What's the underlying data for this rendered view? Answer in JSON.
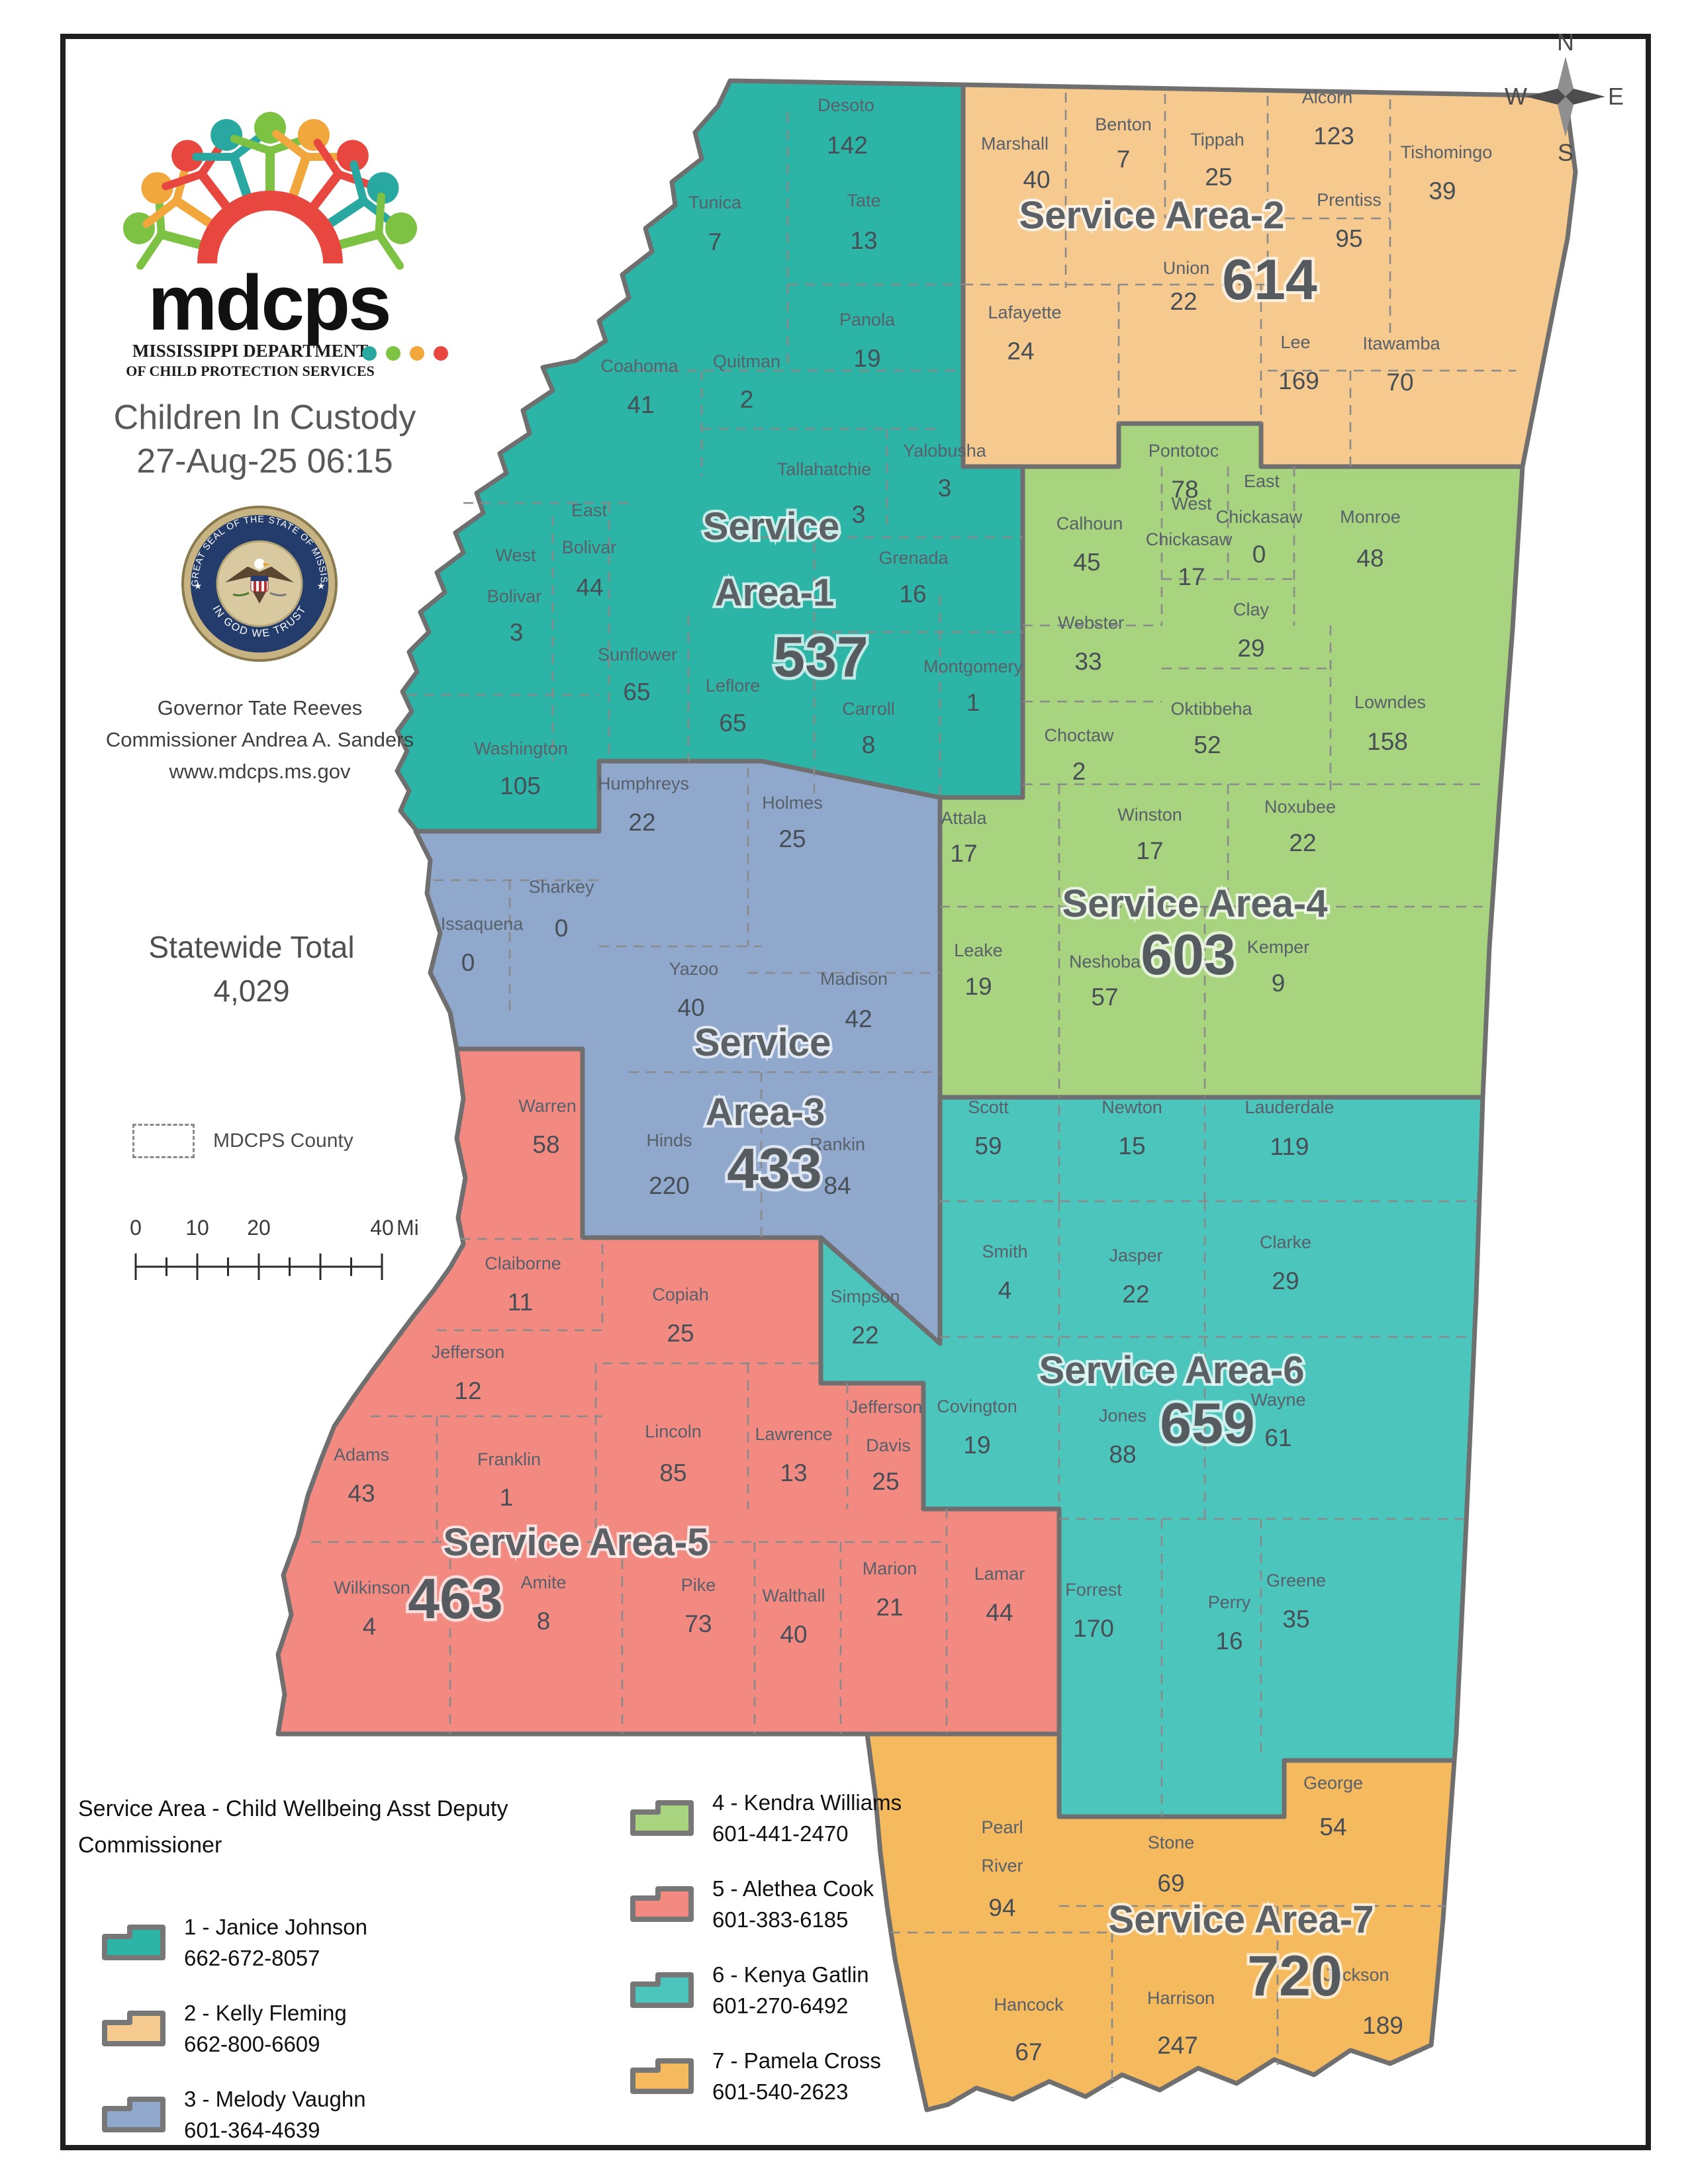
{
  "header": {
    "logo_text": "mdcps",
    "logo_sub1": "MISSISSIPPI DEPARTMENT",
    "logo_sub2": "OF CHILD PROTECTION SERVICES",
    "title": "Children In Custody",
    "datetime": "27-Aug-25 06:15",
    "seal_top": "THE GREAT SEAL OF THE STATE OF MISSISSIPPI",
    "seal_bottom": "IN GOD WE TRUST",
    "governor": "Governor Tate Reeves",
    "commissioner": "Commissioner Andrea A. Sanders",
    "website": "www.mdcps.ms.gov",
    "statewide_label": "Statewide Total",
    "statewide_total": "4,029",
    "county_legend_label": "MDCPS County",
    "scale": {
      "t0": "0",
      "t10": "10",
      "t20": "20",
      "t40": "40",
      "unit": "Miles"
    },
    "compass": {
      "n": "N",
      "e": "E",
      "s": "S",
      "w": "W"
    }
  },
  "legend": {
    "title_line1": "Service Area - Child Wellbeing Asst Deputy",
    "title_line2": "Commissioner",
    "items": [
      {
        "label": "1 - Janice Johnson",
        "phone": "662-672-8057",
        "color": "#2cb5a7"
      },
      {
        "label": "2 - Kelly Fleming",
        "phone": "662-800-6609",
        "color": "#f6c98f"
      },
      {
        "label": "3 - Melody Vaughn",
        "phone": "601-364-4639",
        "color": "#8fa8cc"
      },
      {
        "label": "4 - Kendra Williams",
        "phone": "601-441-2470",
        "color": "#a8d47f"
      },
      {
        "label": "5 - Alethea Cook",
        "phone": "601-383-6185",
        "color": "#f38a82"
      },
      {
        "label": "6 - Kenya Gatlin",
        "phone": "601-270-6492",
        "color": "#4cc5bd"
      },
      {
        "label": "7 - Pamela Cross",
        "phone": "601-540-2623",
        "color": "#f5b95e"
      }
    ]
  },
  "map": {
    "service_areas": [
      {
        "id": 1,
        "label": "Service Area-1",
        "total": "537",
        "color": "#2cb5a7",
        "counties": [
          {
            "name": "Desoto",
            "value": "142"
          },
          {
            "name": "Tunica",
            "value": "7"
          },
          {
            "name": "Tate",
            "value": "13"
          },
          {
            "name": "Panola",
            "value": "19"
          },
          {
            "name": "Coahoma",
            "value": "41"
          },
          {
            "name": "Quitman",
            "value": "2"
          },
          {
            "name": "Tallahatchie",
            "value": "3"
          },
          {
            "name": "Yalobusha",
            "value": "3"
          },
          {
            "name": "East Bolivar",
            "value": "44"
          },
          {
            "name": "West Bolivar",
            "value": "3"
          },
          {
            "name": "Grenada",
            "value": "16"
          },
          {
            "name": "Sunflower",
            "value": "65"
          },
          {
            "name": "Leflore",
            "value": "65"
          },
          {
            "name": "Carroll",
            "value": "8"
          },
          {
            "name": "Montgomery",
            "value": "1"
          },
          {
            "name": "Washington",
            "value": "105"
          }
        ]
      },
      {
        "id": 2,
        "label": "Service Area-2",
        "total": "614",
        "color": "#f6c98f",
        "counties": [
          {
            "name": "Marshall",
            "value": "40"
          },
          {
            "name": "Benton",
            "value": "7"
          },
          {
            "name": "Tippah",
            "value": "25"
          },
          {
            "name": "Alcorn",
            "value": "123"
          },
          {
            "name": "Tishomingo",
            "value": "39"
          },
          {
            "name": "Prentiss",
            "value": "95"
          },
          {
            "name": "Union",
            "value": "22"
          },
          {
            "name": "Lafayette",
            "value": "24"
          },
          {
            "name": "Lee",
            "value": "169"
          },
          {
            "name": "Itawamba",
            "value": "70"
          }
        ]
      },
      {
        "id": 3,
        "label": "Service Area-3",
        "total": "433",
        "color": "#8fa8cc",
        "counties": [
          {
            "name": "Humphreys",
            "value": "22"
          },
          {
            "name": "Holmes",
            "value": "25"
          },
          {
            "name": "Sharkey",
            "value": "0"
          },
          {
            "name": "Issaquena",
            "value": "0"
          },
          {
            "name": "Yazoo",
            "value": "40"
          },
          {
            "name": "Madison",
            "value": "42"
          },
          {
            "name": "Hinds",
            "value": "220"
          },
          {
            "name": "Rankin",
            "value": "84"
          }
        ]
      },
      {
        "id": 4,
        "label": "Service Area-4",
        "total": "603",
        "color": "#a8d47f",
        "counties": [
          {
            "name": "Pontotoc",
            "value": "78"
          },
          {
            "name": "Calhoun",
            "value": "45"
          },
          {
            "name": "West Chickasaw",
            "value": "17"
          },
          {
            "name": "East Chickasaw",
            "value": "0"
          },
          {
            "name": "Monroe",
            "value": "48"
          },
          {
            "name": "Webster",
            "value": "33"
          },
          {
            "name": "Clay",
            "value": "29"
          },
          {
            "name": "Oktibbeha",
            "value": "52"
          },
          {
            "name": "Lowndes",
            "value": "158"
          },
          {
            "name": "Choctaw",
            "value": "2"
          },
          {
            "name": "Attala",
            "value": "17"
          },
          {
            "name": "Winston",
            "value": "17"
          },
          {
            "name": "Noxubee",
            "value": "22"
          },
          {
            "name": "Leake",
            "value": "19"
          },
          {
            "name": "Neshoba",
            "value": "57"
          },
          {
            "name": "Kemper",
            "value": "9"
          }
        ]
      },
      {
        "id": 5,
        "label": "Service Area-5",
        "total": "463",
        "color": "#f38a82",
        "counties": [
          {
            "name": "Warren",
            "value": "58"
          },
          {
            "name": "Claiborne",
            "value": "11"
          },
          {
            "name": "Copiah",
            "value": "25"
          },
          {
            "name": "Jefferson",
            "value": "12"
          },
          {
            "name": "Adams",
            "value": "43"
          },
          {
            "name": "Franklin",
            "value": "1"
          },
          {
            "name": "Lincoln",
            "value": "85"
          },
          {
            "name": "Lawrence",
            "value": "13"
          },
          {
            "name": "Jefferson Davis",
            "value": "25"
          },
          {
            "name": "Wilkinson",
            "value": "4"
          },
          {
            "name": "Amite",
            "value": "8"
          },
          {
            "name": "Pike",
            "value": "73"
          },
          {
            "name": "Walthall",
            "value": "40"
          },
          {
            "name": "Marion",
            "value": "21"
          },
          {
            "name": "Lamar",
            "value": "44"
          }
        ]
      },
      {
        "id": 6,
        "label": "Service Area-6",
        "total": "659",
        "color": "#4cc5bd",
        "counties": [
          {
            "name": "Simpson",
            "value": "22"
          },
          {
            "name": "Scott",
            "value": "59"
          },
          {
            "name": "Newton",
            "value": "15"
          },
          {
            "name": "Lauderdale",
            "value": "119"
          },
          {
            "name": "Smith",
            "value": "4"
          },
          {
            "name": "Jasper",
            "value": "22"
          },
          {
            "name": "Clarke",
            "value": "29"
          },
          {
            "name": "Covington",
            "value": "19"
          },
          {
            "name": "Jones",
            "value": "88"
          },
          {
            "name": "Wayne",
            "value": "61"
          },
          {
            "name": "Forrest",
            "value": "170"
          },
          {
            "name": "Perry",
            "value": "16"
          },
          {
            "name": "Greene",
            "value": "35"
          }
        ]
      },
      {
        "id": 7,
        "label": "Service Area-7",
        "total": "720",
        "color": "#f5b95e",
        "counties": [
          {
            "name": "Pearl River",
            "value": "94"
          },
          {
            "name": "Stone",
            "value": "69"
          },
          {
            "name": "George",
            "value": "54"
          },
          {
            "name": "Hancock",
            "value": "67"
          },
          {
            "name": "Harrison",
            "value": "247"
          },
          {
            "name": "Jackson",
            "value": "189"
          }
        ]
      }
    ]
  }
}
